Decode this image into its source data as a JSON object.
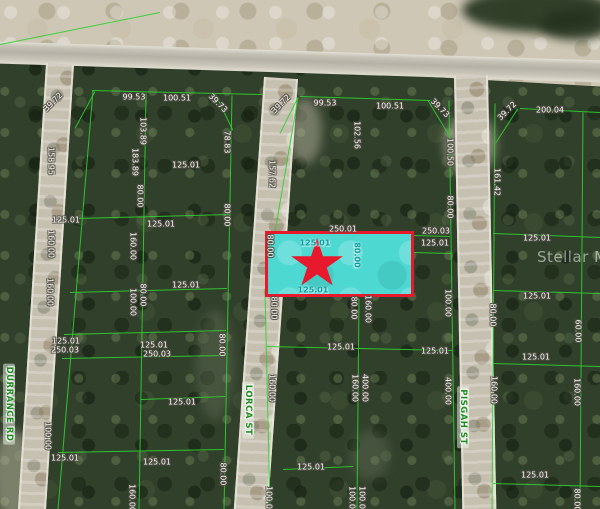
{
  "map": {
    "watermark": {
      "text": "Stellar MLS"
    },
    "streets": [
      {
        "name": "DURRANCE RD",
        "x": 9,
        "y": 404,
        "rotation": 90
      },
      {
        "name": "LORCA ST",
        "x": 248,
        "y": 410,
        "rotation": 90
      },
      {
        "name": "PISGAH ST",
        "x": 463,
        "y": 417,
        "rotation": 90
      }
    ],
    "highlighted_parcel": {
      "x": 265,
      "y": 231,
      "width": 149,
      "height": 66,
      "star": {
        "cx": 317,
        "cy": 265,
        "size": 54
      },
      "labels": [
        {
          "text": "125.01",
          "x": 315,
          "y": 243,
          "rot": 0
        },
        {
          "text": "80.00",
          "x": 357,
          "y": 255,
          "rot": 90
        },
        {
          "text": "125.01",
          "x": 313,
          "y": 290,
          "rot": 0
        }
      ]
    },
    "dimension_labels": [
      {
        "text": "99.53",
        "x": 134,
        "y": 97,
        "rot": 0
      },
      {
        "text": "100.51",
        "x": 177,
        "y": 98,
        "rot": 0
      },
      {
        "text": "39.72",
        "x": 53,
        "y": 102,
        "rot": -45
      },
      {
        "text": "39.73",
        "x": 218,
        "y": 103,
        "rot": 45
      },
      {
        "text": "39.72",
        "x": 281,
        "y": 104,
        "rot": -45
      },
      {
        "text": "99.53",
        "x": 325,
        "y": 103,
        "rot": 0
      },
      {
        "text": "100.51",
        "x": 390,
        "y": 106,
        "rot": 0
      },
      {
        "text": "39.73",
        "x": 440,
        "y": 108,
        "rot": 45
      },
      {
        "text": "39.72",
        "x": 507,
        "y": 111,
        "rot": -45
      },
      {
        "text": "200.04",
        "x": 550,
        "y": 110,
        "rot": 0
      },
      {
        "text": "103.89",
        "x": 143,
        "y": 131,
        "rot": 90
      },
      {
        "text": "78.83",
        "x": 227,
        "y": 142,
        "rot": 90
      },
      {
        "text": "102.56",
        "x": 357,
        "y": 135,
        "rot": 90
      },
      {
        "text": "100.50",
        "x": 450,
        "y": 152,
        "rot": 90
      },
      {
        "text": "158.95",
        "x": 51,
        "y": 161,
        "rot": 90
      },
      {
        "text": "183.89",
        "x": 135,
        "y": 162,
        "rot": 90
      },
      {
        "text": "125.01",
        "x": 186,
        "y": 165,
        "rot": 0
      },
      {
        "text": "157.62",
        "x": 272,
        "y": 174,
        "rot": 90
      },
      {
        "text": "161.42",
        "x": 497,
        "y": 182,
        "rot": 90
      },
      {
        "text": "80.00",
        "x": 140,
        "y": 196,
        "rot": 90
      },
      {
        "text": "80.00",
        "x": 450,
        "y": 207,
        "rot": 90
      },
      {
        "text": "80.00",
        "x": 227,
        "y": 215,
        "rot": 90
      },
      {
        "text": "125.01",
        "x": 66,
        "y": 220,
        "rot": 0
      },
      {
        "text": "125.01",
        "x": 161,
        "y": 224,
        "rot": 0
      },
      {
        "text": "250.01",
        "x": 343,
        "y": 229,
        "rot": 0
      },
      {
        "text": "250.03",
        "x": 436,
        "y": 231,
        "rot": 0
      },
      {
        "text": "125.01",
        "x": 537,
        "y": 238,
        "rot": 0
      },
      {
        "text": "125.01",
        "x": 435,
        "y": 243,
        "rot": 0
      },
      {
        "text": "160.00",
        "x": 51,
        "y": 244,
        "rot": 90
      },
      {
        "text": "160.00",
        "x": 133,
        "y": 246,
        "rot": 90
      },
      {
        "text": "80.00",
        "x": 270,
        "y": 246,
        "rot": 90
      },
      {
        "text": "125.01",
        "x": 186,
        "y": 285,
        "rot": 0
      },
      {
        "text": "160.00",
        "x": 50,
        "y": 292,
        "rot": 90
      },
      {
        "text": "80.00",
        "x": 143,
        "y": 295,
        "rot": 90
      },
      {
        "text": "100.00",
        "x": 133,
        "y": 302,
        "rot": 90
      },
      {
        "text": "125.01",
        "x": 537,
        "y": 296,
        "rot": 0
      },
      {
        "text": "100.00",
        "x": 448,
        "y": 303,
        "rot": 90
      },
      {
        "text": "80.00",
        "x": 274,
        "y": 308,
        "rot": 90
      },
      {
        "text": "80.00",
        "x": 354,
        "y": 308,
        "rot": 90
      },
      {
        "text": "160.00",
        "x": 368,
        "y": 309,
        "rot": 90
      },
      {
        "text": "80.00",
        "x": 493,
        "y": 315,
        "rot": 90
      },
      {
        "text": "60.00",
        "x": 578,
        "y": 331,
        "rot": 90
      },
      {
        "text": "125.01",
        "x": 66,
        "y": 341,
        "rot": 0
      },
      {
        "text": "250.03",
        "x": 65,
        "y": 350,
        "rot": 0
      },
      {
        "text": "125.01",
        "x": 154,
        "y": 345,
        "rot": 0
      },
      {
        "text": "250.03",
        "x": 157,
        "y": 354,
        "rot": 0
      },
      {
        "text": "80.00",
        "x": 222,
        "y": 345,
        "rot": 90
      },
      {
        "text": "125.01",
        "x": 341,
        "y": 347,
        "rot": 0
      },
      {
        "text": "125.01",
        "x": 435,
        "y": 351,
        "rot": 0
      },
      {
        "text": "125.01",
        "x": 536,
        "y": 357,
        "rot": 0
      },
      {
        "text": "160.00",
        "x": 272,
        "y": 388,
        "rot": 90
      },
      {
        "text": "160.00",
        "x": 355,
        "y": 388,
        "rot": 90
      },
      {
        "text": "400.00",
        "x": 365,
        "y": 388,
        "rot": 90
      },
      {
        "text": "400.00",
        "x": 448,
        "y": 391,
        "rot": 90
      },
      {
        "text": "160.00",
        "x": 494,
        "y": 390,
        "rot": 90
      },
      {
        "text": "160.00",
        "x": 577,
        "y": 392,
        "rot": 90
      },
      {
        "text": "125.01",
        "x": 182,
        "y": 402,
        "rot": 0
      },
      {
        "text": "100.00",
        "x": 48,
        "y": 436,
        "rot": 90
      },
      {
        "text": "125.01",
        "x": 65,
        "y": 458,
        "rot": 0
      },
      {
        "text": "125.01",
        "x": 157,
        "y": 462,
        "rot": 0
      },
      {
        "text": "125.01",
        "x": 311,
        "y": 467,
        "rot": 0
      },
      {
        "text": "80.00",
        "x": 223,
        "y": 474,
        "rot": 90
      },
      {
        "text": "125.01",
        "x": 535,
        "y": 475,
        "rot": 0
      },
      {
        "text": "160.00",
        "x": 132,
        "y": 498,
        "rot": 90
      },
      {
        "text": "100.00",
        "x": 269,
        "y": 500,
        "rot": 90
      },
      {
        "text": "100.00",
        "x": 352,
        "y": 500,
        "rot": 90
      },
      {
        "text": "100.00",
        "x": 362,
        "y": 500,
        "rot": 90
      },
      {
        "text": "80.00",
        "x": 577,
        "y": 500,
        "rot": 90
      }
    ],
    "boundary_lines": [
      [
        0,
        44,
        160,
        12
      ],
      [
        92,
        90,
        262,
        94
      ],
      [
        300,
        96,
        430,
        100
      ],
      [
        520,
        108,
        600,
        112
      ],
      [
        75,
        128,
        95,
        91
      ],
      [
        215,
        93,
        233,
        130
      ],
      [
        280,
        133,
        298,
        97
      ],
      [
        428,
        100,
        448,
        133
      ],
      [
        496,
        142,
        518,
        108
      ],
      [
        93,
        90,
        58,
        509
      ],
      [
        146,
        93,
        139,
        509
      ],
      [
        232,
        95,
        224,
        509
      ],
      [
        298,
        97,
        265,
        290
      ],
      [
        265,
        290,
        270,
        509
      ],
      [
        359,
        298,
        357,
        509
      ],
      [
        449,
        100,
        455,
        509
      ],
      [
        495,
        103,
        492,
        509
      ],
      [
        583,
        112,
        580,
        509
      ],
      [
        78,
        218,
        229,
        214
      ],
      [
        70,
        292,
        227,
        288
      ],
      [
        64,
        334,
        226,
        330
      ],
      [
        62,
        358,
        226,
        355
      ],
      [
        141,
        399,
        225,
        396
      ],
      [
        58,
        452,
        224,
        449
      ],
      [
        265,
        231,
        450,
        236
      ],
      [
        413,
        252,
        451,
        253
      ],
      [
        267,
        346,
        452,
        350
      ],
      [
        283,
        469,
        353,
        466
      ],
      [
        493,
        233,
        600,
        237
      ],
      [
        493,
        290,
        600,
        293
      ],
      [
        493,
        363,
        600,
        366
      ],
      [
        493,
        483,
        600,
        486
      ]
    ],
    "colors": {
      "boundary_line": "#2fd12f",
      "highlight_fill": "#4ed8d2",
      "highlight_border": "#e8192c",
      "star": "#e8192c",
      "dimension_text": "#f7f7f2",
      "teal_text": "#0d9ba0",
      "street_text": "#1e8c1e",
      "watermark_text": "rgba(255,255,255,0.52)"
    }
  }
}
